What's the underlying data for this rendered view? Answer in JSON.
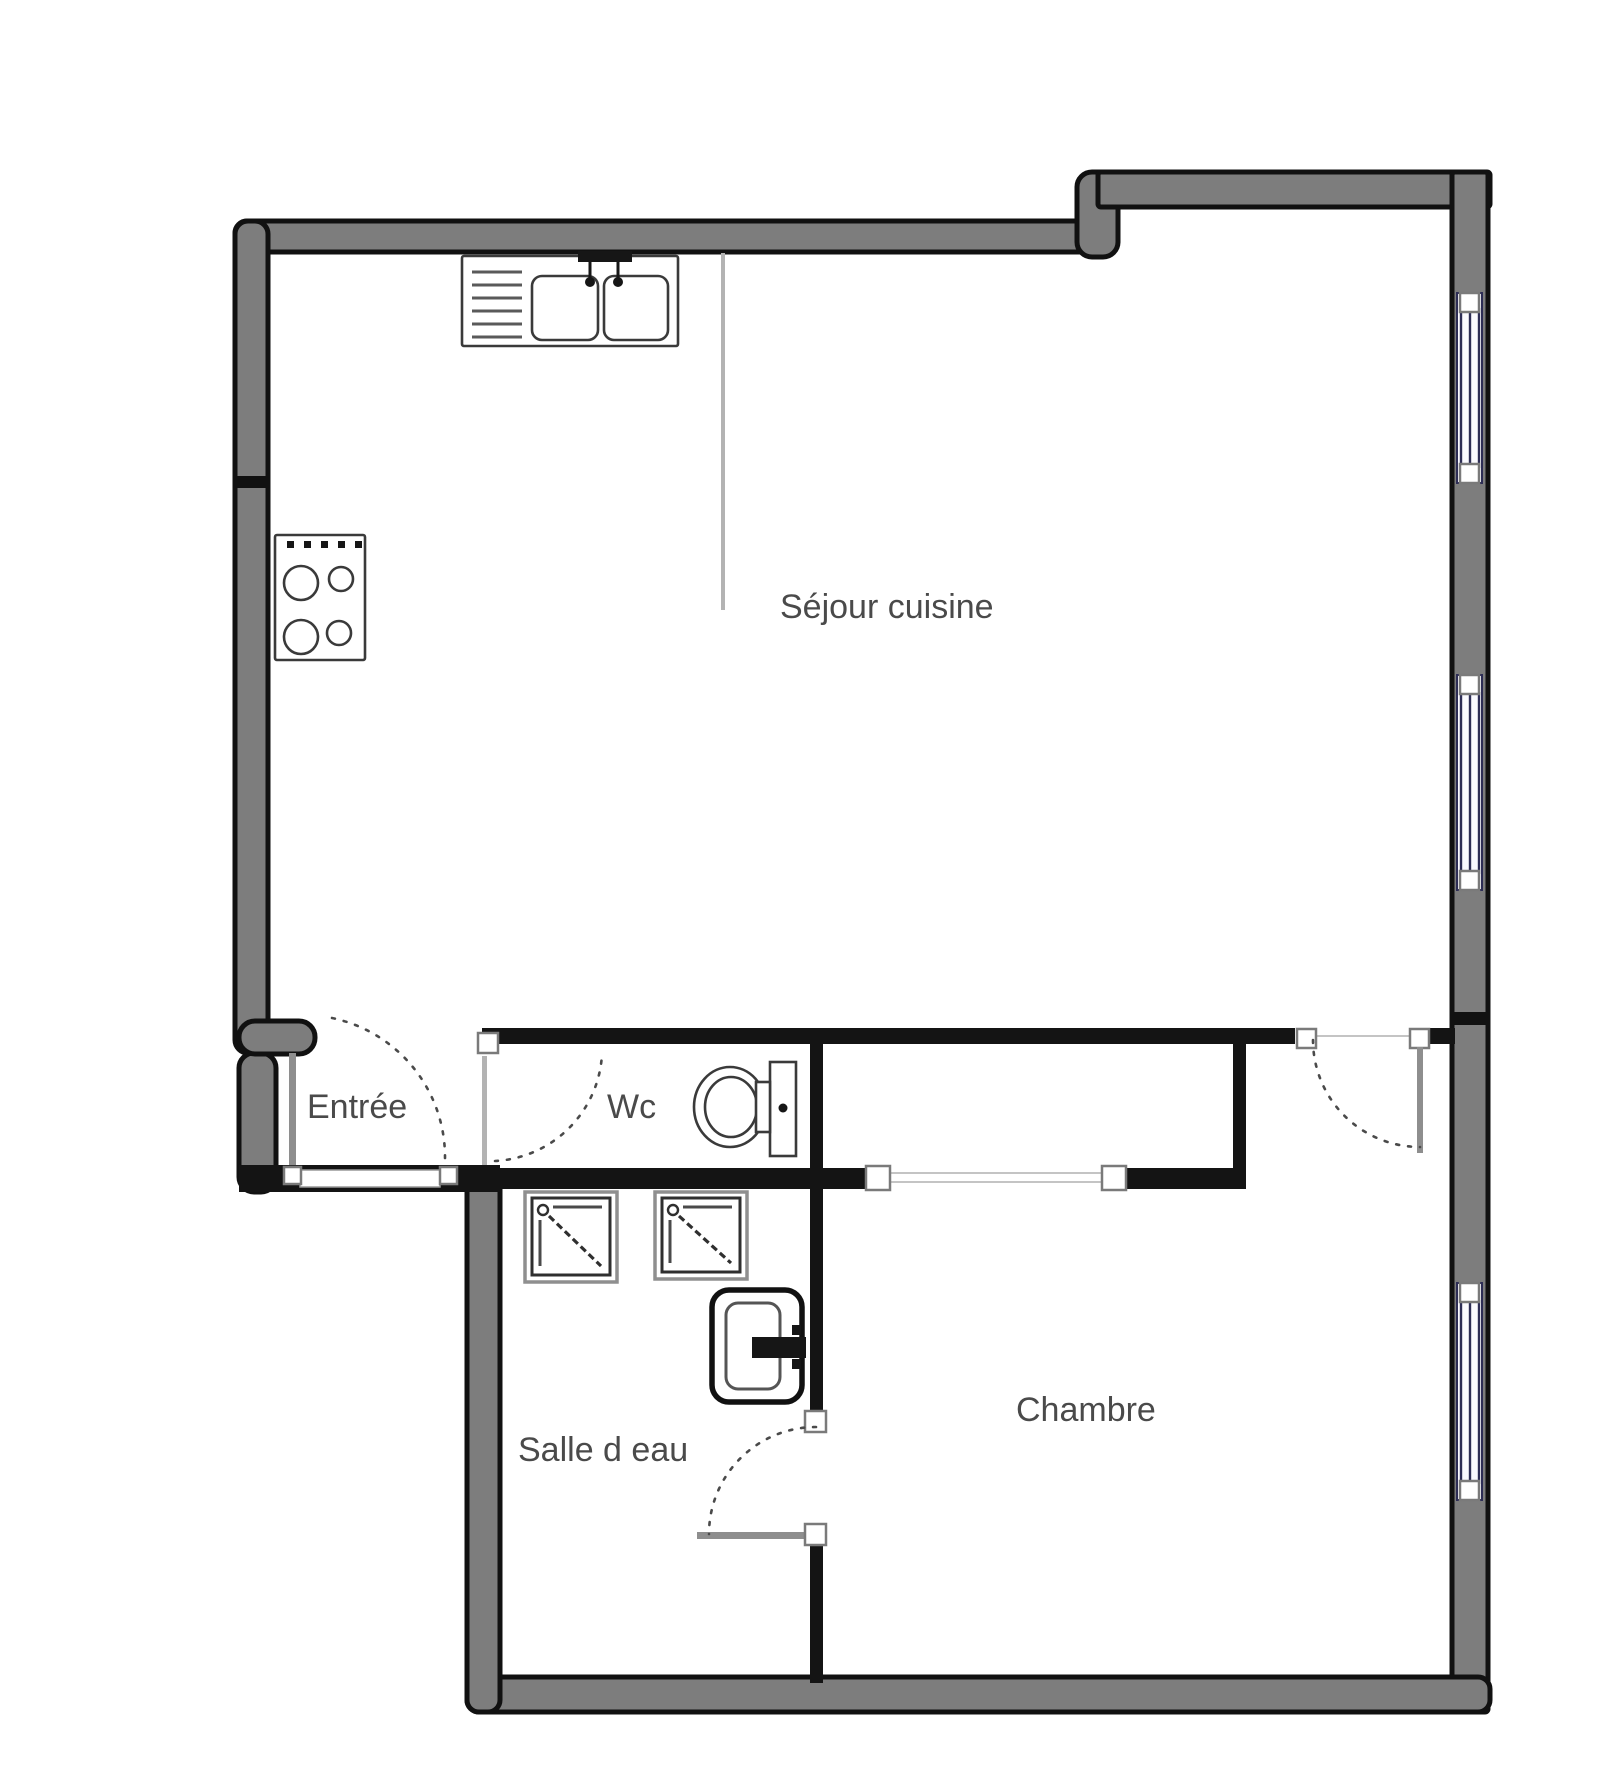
{
  "plan": {
    "title": "Apartment floor plan",
    "rooms": [
      {
        "id": "sejour-cuisine",
        "label": "Séjour cuisine"
      },
      {
        "id": "entree",
        "label": "Entrée"
      },
      {
        "id": "wc",
        "label": "Wc"
      },
      {
        "id": "salle-deau",
        "label": "Salle d eau"
      },
      {
        "id": "chambre",
        "label": "Chambre"
      }
    ],
    "fixtures": [
      {
        "icon": "kitchen-sink-icon",
        "room": "sejour-cuisine"
      },
      {
        "icon": "cooktop-icon",
        "room": "sejour-cuisine"
      },
      {
        "icon": "toilet-icon",
        "room": "wc"
      },
      {
        "icon": "washer-icon",
        "room": "salle-deau"
      },
      {
        "icon": "washer-icon",
        "room": "salle-deau"
      },
      {
        "icon": "washbasin-icon",
        "room": "salle-deau"
      }
    ],
    "window_count": 3,
    "door_count": 5,
    "colors": {
      "background": "#ffffff",
      "wall_fill": "#7d7d7d",
      "wall_border": "#111111",
      "interior_wall": "#141414",
      "window_frame": "#2d2d55",
      "door_leaf": "#8e8e8e",
      "label_text": "#4a4a4a"
    }
  }
}
